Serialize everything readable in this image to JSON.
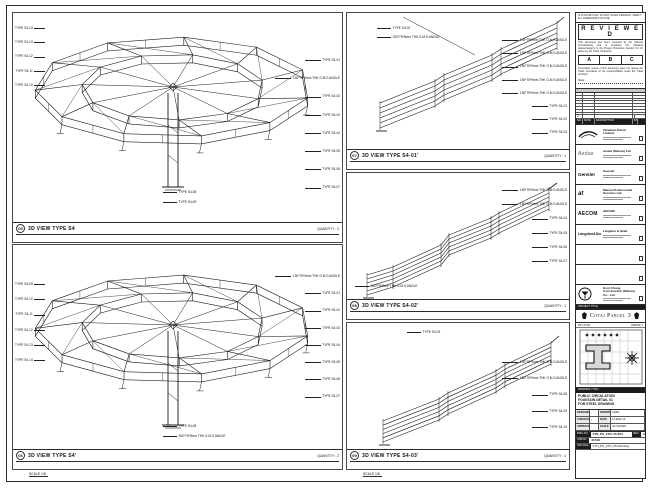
{
  "sheet": {
    "disclaimer": "IF IN DOUBT ASK. DO NOT SCALE DRAWING. VERIFY ALL DIMENSIONS ON SITE.",
    "project_band": "PROJECT TITLE",
    "banner": "Cotai Parcel 3",
    "keyplan_left": "KEY PLAN",
    "keyplan_right": "PARCEL 3"
  },
  "stamp": {
    "title": "R E V I E W E D",
    "para1": "This document has been reviewed by the relevant Consultant(s) and is accorded the following status/category to the Project Procedure Section 5.4 for action by the Trade Contractor.",
    "grades": [
      "A",
      "B",
      "C"
    ],
    "para2": "Consultant review of this document does not relieve the Trade Contractor of his responsibilities under the Trade Contract.",
    "date_label": "Date :"
  },
  "revisions": {
    "row_a": {
      "rev": "A",
      "date": "",
      "desc": "",
      "by": ""
    },
    "header": [
      "NO.",
      "DATE",
      "DESCRIPTION",
      "BY"
    ]
  },
  "companies": [
    {
      "name": "Venetian Orient Limited"
    },
    {
      "name": "Aedas (Macau) Ltd."
    },
    {
      "name": "Gensler"
    },
    {
      "name": "Macau Professional Services Ltd."
    },
    {
      "name": "AECOM"
    },
    {
      "name": "Langdon & Seah"
    },
    {
      "name": ""
    },
    {
      "name": ""
    },
    {
      "name": "Hsin Chong Construction (Macau) Co., Ltd."
    }
  ],
  "logos": {
    "aedas": "Aedas",
    "gensler": "Gensler",
    "mps": "at",
    "aecom": "AECOM",
    "langdon": "Langdon&Seah"
  },
  "titleblock": {
    "dt_label": "DRAWING TITLE :",
    "title1": "PUBLIC CIRCULATION",
    "title2": "FOUNTAIN DETAIL 01",
    "title3": "FOR STEEL DRAWING",
    "fields": {
      "designed_label": "DESIGNED",
      "designed": "-",
      "drawn_label": "DRAWN",
      "drawn": "CHAD",
      "checked_label": "CHECKED",
      "checked": "-",
      "date_label": "DATE",
      "date": "14-MAR-16",
      "approved_label": "APPROVED",
      "approved": "-",
      "scale_label": "SCALE",
      "scale": "AS SHOWN"
    },
    "dwg_label": "DWG NO. :",
    "dwg_no": "FTN_PS_FTD_05-004",
    "rev_label": "REV :",
    "rev": "A",
    "job_label": "JOB NO. :",
    "job_no": "31518",
    "cad_label": "CAD FILE :",
    "cad_file": "FTN_PS_FTD_05-004.dwg"
  },
  "views": {
    "v1": {
      "num": "05",
      "title": "3D VIEW TYPE S4",
      "scale": "SCALE 1/8",
      "quantity": "QUANTITY : 2",
      "left": [
        "TYPE S4-14",
        "TYPE S4-13",
        "TYPE S4-12",
        "TYPE S4-11",
        "TYPE S4-10"
      ],
      "right": [
        "TYPE S4-01",
        "150*75*9mm THK G.M.S ANGLE",
        "TYPE S4-02",
        "TYPE S4-03",
        "TYPE S4-04",
        "TYPE S4-05",
        "TYPE S4-06",
        "TYPE S4-07"
      ],
      "bottom": [
        "TYPE S4-08",
        "TYPE S4-09"
      ]
    },
    "v2": {
      "num": "06",
      "title": "3D VIEW TYPE S4'",
      "scale": "SCALE 1/8",
      "quantity": "QUANTITY : 2",
      "left": [
        "TYPE S4-09",
        "TYPE S4-10",
        "TYPE S4-11",
        "TYPE S4-12",
        "TYPE S4-13",
        "TYPE S4-14"
      ],
      "right": [
        "150*75*9mm THK G.M.S ANGLE",
        "TYPE S4-01",
        "TYPE S4-02",
        "TYPE S4-03",
        "TYPE S4-04",
        "TYPE S4-05",
        "TYPE S4-06",
        "TYPE S4-07"
      ],
      "bottom": [
        "TYPE S4-08",
        "150*75*9mm THK G.M.S ANGLE"
      ]
    },
    "v3": {
      "num": "07",
      "title": "3D VIEW TYPE S4-01'",
      "scale": "SCALE 1/8",
      "quantity": "QUANTITY : 1",
      "topleft": [
        "TYPE S4-02",
        "150*75*9mm THK G.M.S ANGLE"
      ],
      "right": [
        "150*75*9mm THK G.M.S ANGLE",
        "150*75*9mm THK G.M.S ANGLE",
        "150*75*9mm THK G.M.S ANGLE",
        "150*75*9mm THK G.M.S ANGLE",
        "150*75*9mm THK G.M.S ANGLE",
        "TYPE S4-01",
        "TYPE S4-02",
        "TYPE S4-03"
      ]
    },
    "v4": {
      "num": "08",
      "title": "3D VIEW TYPE S4-02'",
      "scale": "SCALE 1/8",
      "quantity": "QUANTITY : 1",
      "right": [
        "150*75*9mm THK G.M.S ANGLE",
        "150*75*9mm THK G.M.S ANGLE",
        "TYPE S4-04",
        "TYPE S4-05",
        "TYPE S4-06",
        "TYPE S4-07"
      ],
      "bottomleft": [
        "150*75*9mm THK G.M.S ANGLE"
      ]
    },
    "v5": {
      "num": "09",
      "title": "3D VIEW TYPE S4-03'",
      "scale": "SCALE 1/8",
      "quantity": "QUANTITY : 1",
      "top": [
        "TYPE S4-03"
      ],
      "right": [
        "150*75*9mm THK G.M.S ANGLE",
        "150*75*9mm THK G.M.S ANGLE",
        "TYPE S4-08",
        "TYPE S4-09",
        "TYPE S4-10"
      ]
    }
  }
}
